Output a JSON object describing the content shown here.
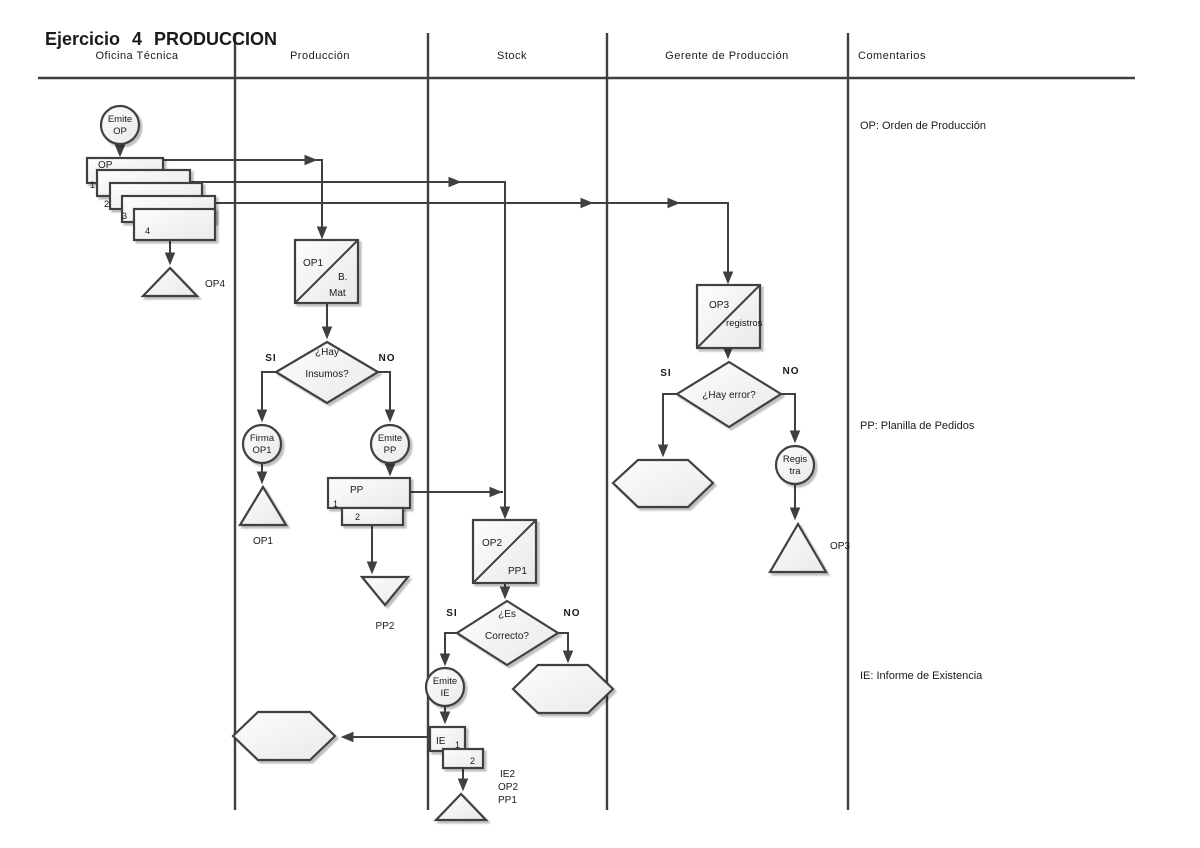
{
  "title": "Ejercicio 4 PRODUCCION",
  "lanes": {
    "oficina": "Oficina Técnica",
    "produccion": "Producción",
    "stock": "Stock",
    "gerente": "Gerente de Producción",
    "comentarios": "Comentarios"
  },
  "comments": {
    "op": "OP: Orden de Producción",
    "pp": "PP: Planilla de Pedidos",
    "ie": "IE: Informe de Existencia"
  },
  "colors": {
    "line": "#404040",
    "text": "#1a1a1a",
    "shape_fill_top": "#fdfdfd",
    "shape_fill_bottom": "#e9e9e9"
  },
  "nodes": {
    "emite_op": {
      "l1": "Emite",
      "l2": "OP"
    },
    "doc_op": {
      "label": "OP",
      "c1": "1",
      "c2": "2",
      "c3": "3",
      "c4": "4"
    },
    "archive_op4": "OP4",
    "op_square1": {
      "tl": "OP1",
      "br1": "B.",
      "br2": "Mat"
    },
    "dec_insumos": {
      "l1": "¿Hay",
      "l2": "Insumos?",
      "si": "SI",
      "no": "NO"
    },
    "firma_op1": {
      "l1": "Firma",
      "l2": "OP1"
    },
    "archive_op1": "OP1",
    "emite_pp": {
      "l1": "Emite",
      "l2": "PP"
    },
    "doc_pp": {
      "label": "PP",
      "c1": "1",
      "c2": "2"
    },
    "archive_pp2": "PP2",
    "op_square2": {
      "tl": "OP2",
      "br": "PP1"
    },
    "dec_correcto": {
      "l1": "¿Es",
      "l2": "Correcto?",
      "si": "SI",
      "no": "NO"
    },
    "emite_ie": {
      "l1": "Emite",
      "l2": "IE"
    },
    "doc_ie": {
      "label": "IE",
      "c1": "1",
      "c2": "2"
    },
    "archive_ie": {
      "l1": "IE2",
      "l2": "OP2",
      "l3": "PP1"
    },
    "op_square3": {
      "tl": "OP3",
      "br": "registros"
    },
    "dec_error": {
      "label": "¿Hay error?",
      "si": "SI",
      "no": "NO"
    },
    "registra": {
      "l1": "Regis",
      "l2": "tra"
    },
    "archive_op3": "OP3"
  }
}
